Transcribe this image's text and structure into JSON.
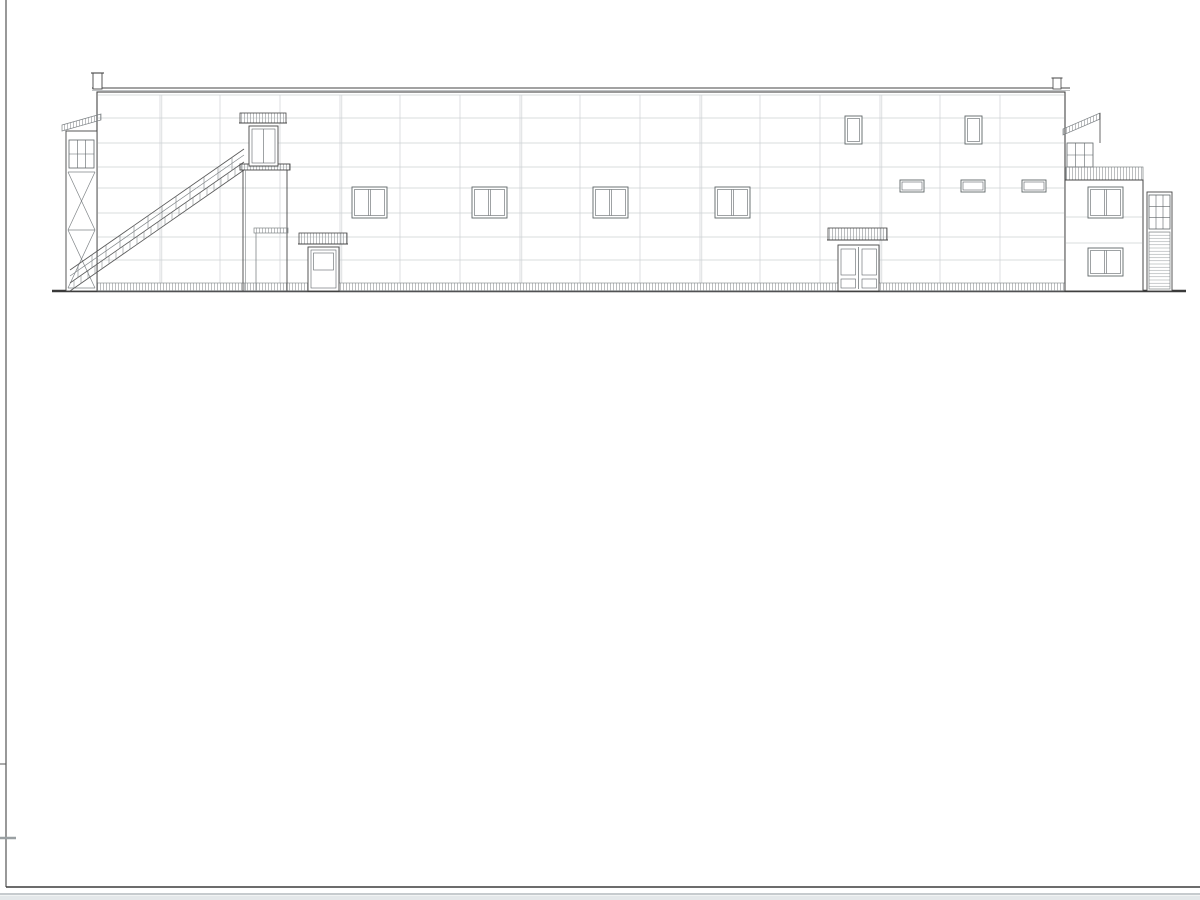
{
  "drawing": {
    "facade1": {
      "title": "Фасад 1-13",
      "markers": [
        {
          "t": "+10.850",
          "x": 36,
          "y": 65
        },
        {
          "t": "+10.030",
          "x": 36,
          "y": 100,
          "up": 1
        },
        {
          "t": "+8.970",
          "x": 62,
          "y": 103
        },
        {
          "t": "+8.260",
          "x": 35,
          "y": 118
        },
        {
          "t": "+8.700",
          "x": 62,
          "y": 128,
          "up": 1,
          "boxed": 1
        },
        {
          "t": "+7.360",
          "x": 35,
          "y": 134
        },
        {
          "t": "+6.160",
          "x": 35,
          "y": 158
        },
        {
          "t": "+5.080",
          "x": 35,
          "y": 180
        },
        {
          "t": "+4.255",
          "x": 62,
          "y": 197
        },
        {
          "t": "+3.880",
          "x": 35,
          "y": 204
        },
        {
          "t": "+3.055",
          "x": 62,
          "y": 221
        },
        {
          "t": "+2.100",
          "x": 35,
          "y": 240
        },
        {
          "t": "+0.350",
          "x": 62,
          "y": 274
        },
        {
          "t": "Ур.зем.",
          "x": 36,
          "y": 283
        },
        {
          "t": "+2.820",
          "x": 921,
          "y": 225
        },
        {
          "t": "+2.550",
          "x": 920,
          "y": 251,
          "up": 1,
          "boxed": 1
        },
        {
          "t": "+3.880",
          "x": 1078,
          "y": 206
        },
        {
          "t": "+10.200",
          "x": 1182,
          "y": 77
        },
        {
          "t": "+8.650",
          "x": 1181,
          "y": 110
        },
        {
          "t": "+7.450",
          "x": 1181,
          "y": 132
        },
        {
          "t": "+6.270",
          "x": 1181,
          "y": 157
        },
        {
          "t": "+5.480",
          "x": 1181,
          "y": 171
        },
        {
          "t": "+5.080",
          "x": 1184,
          "y": 198,
          "up": 1,
          "boxed": 1
        },
        {
          "t": "+5.",
          "x": 1190,
          "y": 164,
          "start": 1
        },
        {
          "t": "+5.",
          "x": 1192,
          "y": 180,
          "start": 1
        },
        {
          "t": "+4.",
          "x": 1192,
          "y": 196,
          "start": 1
        },
        {
          "t": "+2.",
          "x": 1190,
          "y": 226,
          "start": 1
        },
        {
          "t": "+2.",
          "x": 1192,
          "y": 243,
          "start": 1
        },
        {
          "t": "+0.",
          "x": 1192,
          "y": 272,
          "start": 1
        },
        {
          "t": "0.0",
          "x": 1190,
          "y": 289,
          "start": 1
        }
      ],
      "axes": [
        {
          "n": "1",
          "x": 98
        },
        {
          "n": "11",
          "x": 1063
        },
        {
          "n": "13",
          "x": 1142
        }
      ],
      "dims": [
        {
          "t": "48000",
          "x": 580,
          "y": 313,
          "shade": "dark"
        },
        {
          "t": "3920",
          "x": 1102,
          "y": 312,
          "shade": "light"
        }
      ]
    },
    "facade2": {
      "title": "Фасад 13-1",
      "markers": [
        {
          "t": "+10.200",
          "x": 40,
          "y": 416
        },
        {
          "t": "+8.650",
          "x": 39,
          "y": 448
        },
        {
          "t": "+7.450",
          "x": 38,
          "y": 471
        },
        {
          "t": "+6.270",
          "x": 38,
          "y": 494
        },
        {
          "t": "+5.080",
          "x": 38,
          "y": 518
        },
        {
          "t": "+4.160",
          "x": 64,
          "y": 537
        },
        {
          "t": "+3.880",
          "x": 38,
          "y": 542
        },
        {
          "t": "+2.960",
          "x": 38,
          "y": 561
        },
        {
          "t": "+2.200",
          "x": 38,
          "y": 576
        },
        {
          "t": "0.000",
          "x": 39,
          "y": 619
        },
        {
          "t": "+10",
          "x": 1189,
          "y": 402,
          "start": 1
        },
        {
          "t": "+1",
          "x": 1192,
          "y": 417,
          "start": 1
        },
        {
          "t": "+8",
          "x": 1191,
          "y": 441,
          "start": 1
        },
        {
          "t": "+8",
          "x": 1192,
          "y": 462,
          "start": 1,
          "up": 1,
          "boxed": 1
        },
        {
          "t": "+7",
          "x": 1191,
          "y": 473,
          "start": 1
        },
        {
          "t": "+6",
          "x": 1192,
          "y": 497,
          "start": 1
        },
        {
          "t": "+5",
          "x": 1191,
          "y": 511,
          "start": 1
        },
        {
          "t": "+5",
          "x": 1192,
          "y": 536,
          "start": 1,
          "up": 1,
          "boxed": 1
        },
        {
          "t": "+3",
          "x": 1191,
          "y": 556,
          "start": 1
        },
        {
          "t": "Ур",
          "x": 1192,
          "y": 621,
          "start": 1
        }
      ],
      "axes": [
        {
          "n": "13",
          "x": 98
        },
        {
          "n": "11",
          "x": 177
        },
        {
          "n": "1",
          "x": 1140
        }
      ],
      "dims": [
        {
          "t": "3920",
          "x": 139,
          "y": 648,
          "shade": "light"
        },
        {
          "t": "48000",
          "x": 660,
          "y": 648,
          "shade": "dark"
        }
      ]
    }
  },
  "title_block": {
    "code": "16-23П",
    "description_lines": [
      "«Здание производственного цеха с АБК»,",
      "расположенное по адресу: Владимирская область,",
      "ЗАТО г. Радужный, 17 квартал, кадастровый номер",
      "земельного участка 33:23:000101:456, 33:23:000101:508"
    ],
    "designer_org": "ООО \"СтройМастер\"",
    "contractor_org": "ООО \"Альянс\"",
    "stage_label": "Стадия",
    "sheet_label": "Лист",
    "sheets_label": "Лис",
    "stage_value": "ЭП",
    "sheet_value": "9",
    "sheets_value": "1",
    "doc_title_line1": "Фасад 1-13",
    "doc_title_line2": "Фасад 13-1",
    "columns": [
      "Изм.",
      "Кол.",
      "Лист",
      "№док.",
      "Подл.",
      "Дата"
    ],
    "rows": [
      {
        "role": "Разработал",
        "name": "Решетова",
        "date": "05.23"
      },
      {
        "role": "Н. контр.",
        "name": "Коротаев",
        "date": "05.23"
      },
      {
        "role": "ГИП",
        "name": "Коротаев",
        "date": "05.23"
      }
    ]
  }
}
